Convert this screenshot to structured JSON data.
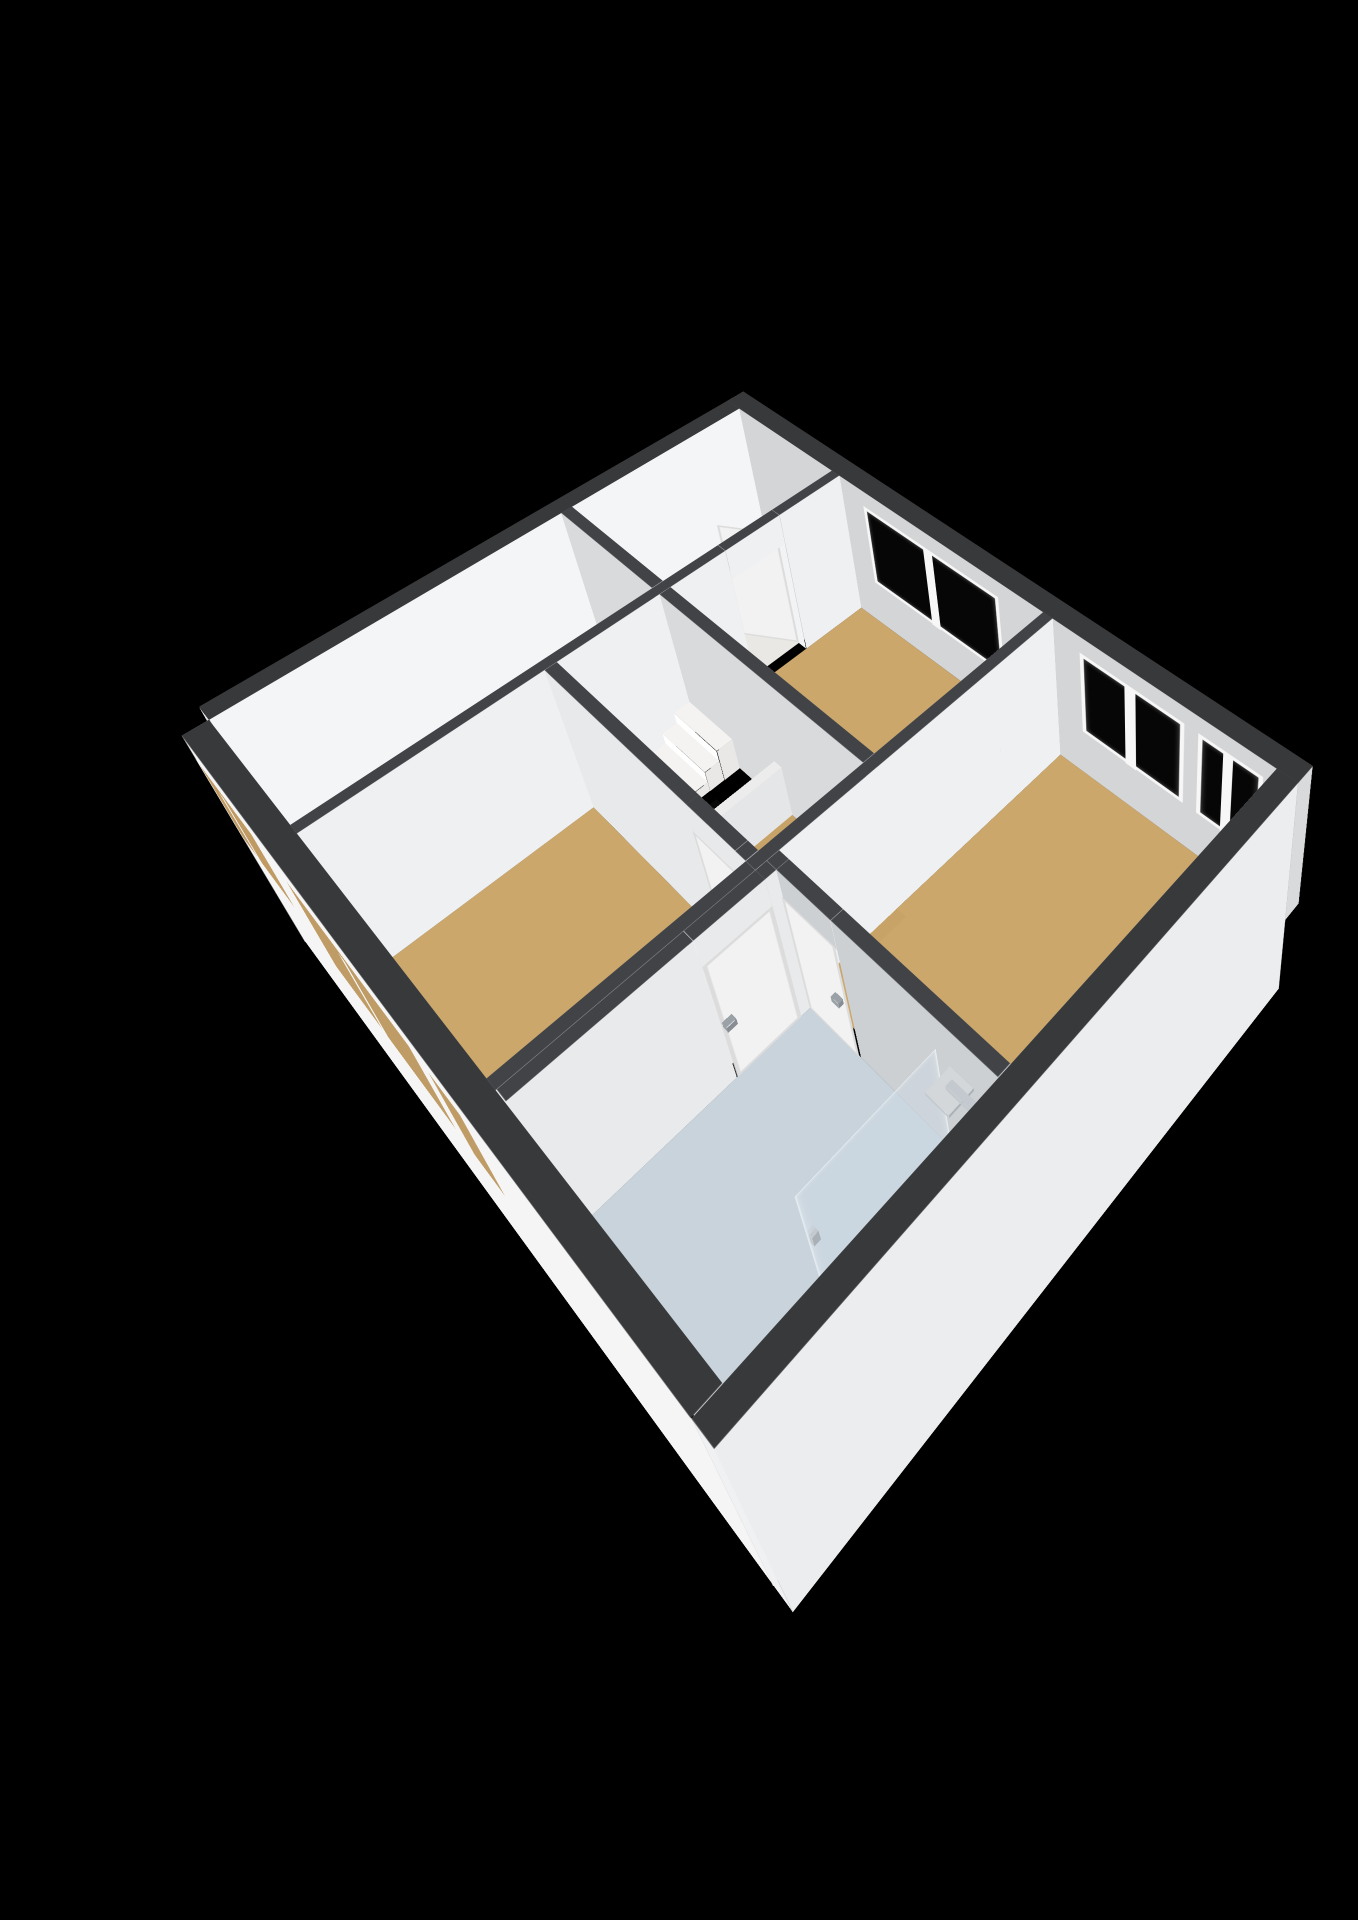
{
  "meta": {
    "kind": "3d-floorplan",
    "storey": "upper floor",
    "visible_text": []
  },
  "canvas": {
    "width": 1358,
    "height": 1920,
    "background": "#000000"
  },
  "scene": {
    "camera": {
      "left": 770,
      "top": 520,
      "rotX": 56,
      "rotZ": 40,
      "scale": 0.63,
      "perspective": 1400,
      "perspectiveOriginX": 1150,
      "perspectiveOriginY": 280
    },
    "palette": {
      "extTop": "#38393b",
      "intTop": "#414346",
      "frame": "#f7f7f7",
      "glassDark": "#060606",
      "floorTan": "#cba76c",
      "floorHall": "#e9e8e4",
      "floorBath": "#c9d3dc",
      "hole": "#0a0a0a",
      "holeSide": "#161617",
      "stair": "#edece8",
      "balustrade": "#fafafa",
      "doorLeaf": "#f2f2f2",
      "doorEdge": "#dcdcdc",
      "handle": "#9aa1a7",
      "chrome": "#c3c9ce",
      "showerGlass": "rgba(205,218,228,0.45)"
    },
    "floors": [
      {
        "name": "floor-hall-top",
        "r": [
          28,
          28,
          238,
          298
        ],
        "z": 0,
        "c": "#e9e8e4"
      },
      {
        "name": "floor-hall-patch",
        "r": [
          60,
          100,
          150,
          190
        ],
        "z": 1,
        "c": "#f3f2ef"
      },
      {
        "name": "floor-bedroom-a",
        "r": [
          254,
          28,
          640,
          298
        ],
        "z": 0,
        "c": "#cba76c"
      },
      {
        "name": "floor-bedroom-b",
        "r": [
          656,
          28,
          992,
          440
        ],
        "z": 0,
        "c": "#cba76c"
      },
      {
        "name": "floor-bedroom-c",
        "r": [
          28,
          314,
          238,
          752
        ],
        "z": 0,
        "c": "#cba76c"
      },
      {
        "name": "floor-landing",
        "r": [
          444,
          314,
          672,
          454
        ],
        "z": 0,
        "c": "#c7a368"
      },
      {
        "name": "floor-bedroom-d",
        "r": [
          254,
          470,
          640,
          752
        ],
        "z": 0,
        "c": "#cba76c"
      },
      {
        "name": "floor-bathroom",
        "r": [
          672,
          456,
          992,
          752
        ],
        "z": 0,
        "c": "#c9d3dc"
      },
      {
        "name": "stairwell-bottom",
        "r": [
          254,
          314,
          444,
          454
        ],
        "z": -150,
        "c": "#0a0a0a"
      }
    ],
    "walls": [
      {
        "name": "wall-ext-ne",
        "r": [
          0,
          0,
          1020,
          28
        ],
        "zb": 0,
        "zt": 260,
        "top": "#38393b",
        "py": "#d3d5d7",
        "ny": "#2e2f30",
        "px": "#d9dadb",
        "nx": "#d9dadb"
      },
      {
        "name": "wall-ext-nw",
        "r": [
          0,
          28,
          28,
          752
        ],
        "zb": 0,
        "zt": 260,
        "top": "#38393b",
        "px": "#f4f5f6",
        "nx": "#2e2f30",
        "py": "#e9eaeb",
        "ny": "#c9cbcd"
      },
      {
        "name": "wall-ext-se",
        "r": [
          992,
          28,
          1020,
          780
        ],
        "zb": -150,
        "zt": 260,
        "top": "#38393b",
        "px": "#ebedee",
        "nx": "#c6c9cb",
        "py": "#f0f1f2",
        "ny": "#c4c6c8"
      },
      {
        "name": "wall-ext-sw",
        "r": [
          28,
          752,
          992,
          780
        ],
        "zb": -150,
        "zt": 260,
        "top": "#38393b",
        "py": "#f5f5f6",
        "ny": "#d8d9da",
        "px": "#eff0f1",
        "nx": "#d0d1d2"
      },
      {
        "name": "wall-bedroomA-left-a",
        "r": [
          238,
          28,
          254,
          130
        ],
        "zb": 0,
        "zt": 260
      },
      {
        "name": "wall-bedroomA-left-head",
        "r": [
          238,
          130,
          254,
          216
        ],
        "zb": 208,
        "zt": 260,
        "bot": "#e8e8e8"
      },
      {
        "name": "wall-bedroomA-left-b",
        "r": [
          238,
          216,
          254,
          752
        ],
        "zb": 0,
        "zt": 260
      },
      {
        "name": "wall-a-b-divider",
        "r": [
          640,
          28,
          656,
          440
        ],
        "zb": 0,
        "zt": 260
      },
      {
        "name": "wall-junction-fill",
        "r": [
          640,
          440,
          656,
          470
        ],
        "zb": 0,
        "zt": 260
      },
      {
        "name": "wall-b-landing-a",
        "r": [
          656,
          440,
          672,
          456
        ],
        "zb": 0,
        "zt": 260,
        "py": "#cdd0d3"
      },
      {
        "name": "wall-b-landing-head",
        "r": [
          672,
          440,
          758,
          456
        ],
        "zb": 208,
        "zt": 260,
        "py": "#cdd0d3",
        "bot": "#e8e8e8"
      },
      {
        "name": "wall-b-landing-b",
        "r": [
          758,
          440,
          992,
          456
        ],
        "zb": 0,
        "zt": 260,
        "py": "#cdd0d3"
      },
      {
        "name": "wall-bath-left-a",
        "r": [
          656,
          456,
          672,
          470
        ],
        "zb": 0,
        "zt": 260,
        "px": "#e8eaeb"
      },
      {
        "name": "wall-bath-left-head",
        "r": [
          656,
          470,
          672,
          556
        ],
        "zb": 208,
        "zt": 260,
        "px": "#e8eaeb",
        "bot": "#e8e8e8"
      },
      {
        "name": "wall-bath-left-b",
        "r": [
          656,
          556,
          672,
          752
        ],
        "zb": 0,
        "zt": 260,
        "px": "#e8eaeb"
      },
      {
        "name": "wall-hall-c",
        "r": [
          28,
          298,
          238,
          314
        ],
        "zb": 0,
        "zt": 260,
        "py": "#d8dadb"
      },
      {
        "name": "wall-bedroomA-bottom",
        "r": [
          254,
          298,
          640,
          314
        ],
        "zb": 0,
        "zt": 260,
        "py": "#d8dadb"
      },
      {
        "name": "wall-d-top-a",
        "r": [
          254,
          454,
          536,
          470
        ],
        "zb": 0,
        "zt": 260,
        "py": "#e8e9ea"
      },
      {
        "name": "wall-d-top-head",
        "r": [
          536,
          454,
          622,
          470
        ],
        "zb": 208,
        "zt": 260,
        "py": "#e8e9ea",
        "bot": "#e8e8e8"
      },
      {
        "name": "wall-d-top-b",
        "r": [
          622,
          454,
          640,
          470
        ],
        "zb": 0,
        "zt": 260,
        "py": "#e8e9ea"
      },
      {
        "name": "wall-d-right",
        "r": [
          640,
          470,
          656,
          752
        ],
        "zb": 0,
        "zt": 260
      }
    ],
    "stairs": {
      "steps": [
        {
          "name": "stair-step-1",
          "r": [
            254,
            314,
            348,
            338
          ],
          "zb": 0,
          "zt": 58
        },
        {
          "name": "stair-step-2",
          "r": [
            254,
            338,
            348,
            360
          ],
          "zb": 0,
          "zt": 38
        },
        {
          "name": "stair-step-3",
          "r": [
            254,
            360,
            348,
            382
          ],
          "zb": 0,
          "zt": 18
        }
      ],
      "flight": {
        "name": "stair-flight",
        "x1": 254,
        "x2": 348,
        "y": 382,
        "z": 0,
        "len": 123,
        "ang": -54.2
      },
      "balustrade": {
        "name": "stair-balustrade",
        "r": [
          444,
          314,
          458,
          454
        ],
        "zb": 0,
        "zt": 96
      },
      "holeSideY": {
        "name": "stairwell-side-far",
        "x1": 254,
        "x2": 444,
        "y": 454,
        "zb": -150,
        "zt": 0,
        "c": "#161617"
      },
      "holeSideX": {
        "name": "stairwell-side-right",
        "y1": 314,
        "y2": 454,
        "x": 444,
        "zb": -150,
        "zt": 0,
        "c": "#1d1d1e"
      }
    },
    "windows": [
      {
        "name": "window-bedroom-a",
        "wall": "ne",
        "a1": 300,
        "a2": 560,
        "z1": 84,
        "z2": 232,
        "fill": "#060606",
        "bars": [
          [
            421,
            439
          ]
        ]
      },
      {
        "name": "window-bedroom-b-1",
        "wall": "ne",
        "a1": 700,
        "a2": 864,
        "z1": 84,
        "z2": 232,
        "fill": "#060606",
        "bars": [
          [
            773,
            791
          ]
        ]
      },
      {
        "name": "window-bedroom-b-2",
        "wall": "ne",
        "a1": 884,
        "a2": 976,
        "z1": 84,
        "z2": 232,
        "fill": "#060606",
        "bars": [
          [
            921,
            935
          ]
        ]
      },
      {
        "name": "window-bedroom-c",
        "wall": "sw",
        "a1": 40,
        "a2": 190,
        "z1": 84,
        "z2": 232,
        "fill": "#c09a63",
        "bars": [
          [
            108,
            122
          ]
        ]
      },
      {
        "name": "window-bedroom-d-1",
        "wall": "sw",
        "a1": 264,
        "a2": 540,
        "z1": 60,
        "z2": 232,
        "fill": "#bf9c66",
        "bars": [
          [
            395,
            409
          ]
        ]
      },
      {
        "name": "window-bed-d-2",
        "wall": "sw",
        "a1": 564,
        "a2": 636,
        "z1": 60,
        "z2": 232,
        "fill": "#bf9c66",
        "bars": []
      }
    ],
    "doors": [
      {
        "name": "door-bedroom-a-open",
        "type": "open",
        "hinge": [
          238,
          130
        ],
        "w": 86,
        "h": 216,
        "ang": 150
      },
      {
        "name": "door-bedroom-b",
        "type": "flat",
        "plane": "xz",
        "x1": 672,
        "x2": 758,
        "y": 457.5,
        "z1": 2,
        "z2": 216,
        "handle": {
          "r": [
            738,
            456,
            750,
            464
          ],
          "zb": 100,
          "zt": 110
        }
      },
      {
        "name": "door-bedroom-d",
        "type": "flat",
        "plane": "xz",
        "x1": 536,
        "x2": 622,
        "y": 471.5,
        "z1": 2,
        "z2": 216,
        "handle": {
          "r": [
            600,
            470,
            612,
            478
          ],
          "zb": 100,
          "zt": 110
        }
      },
      {
        "name": "door-bathroom",
        "type": "flat",
        "plane": "yz",
        "y1": 470,
        "y2": 556,
        "x": 673.5,
        "z1": 2,
        "z2": 216,
        "handle": {
          "r": [
            672,
            542,
            682,
            554
          ],
          "zb": 100,
          "zt": 110
        }
      }
    ],
    "bathroom": {
      "showerGlass": {
        "name": "shower-glass",
        "x": 902,
        "y1": 456,
        "y2": 624,
        "z1": 2,
        "z2": 198
      },
      "fixtures": [
        {
          "name": "shower-riser",
          "r": [
            980,
            468,
            988,
            476
          ],
          "zb": 110,
          "zt": 206
        },
        {
          "name": "shower-arm",
          "r": [
            938,
            468,
            982,
            476
          ],
          "zb": 198,
          "zt": 206
        },
        {
          "name": "shower-head",
          "r": [
            924,
            458,
            956,
            490
          ],
          "zb": 192,
          "zt": 197,
          "top": "#d3d7da"
        },
        {
          "name": "shower-mixer",
          "r": [
            976,
            498,
            992,
            540
          ],
          "zb": 88,
          "zt": 100
        },
        {
          "name": "shower-glass-handle",
          "r": [
            898,
            614,
            906,
            622
          ],
          "zb": 100,
          "zt": 118
        }
      ]
    }
  }
}
